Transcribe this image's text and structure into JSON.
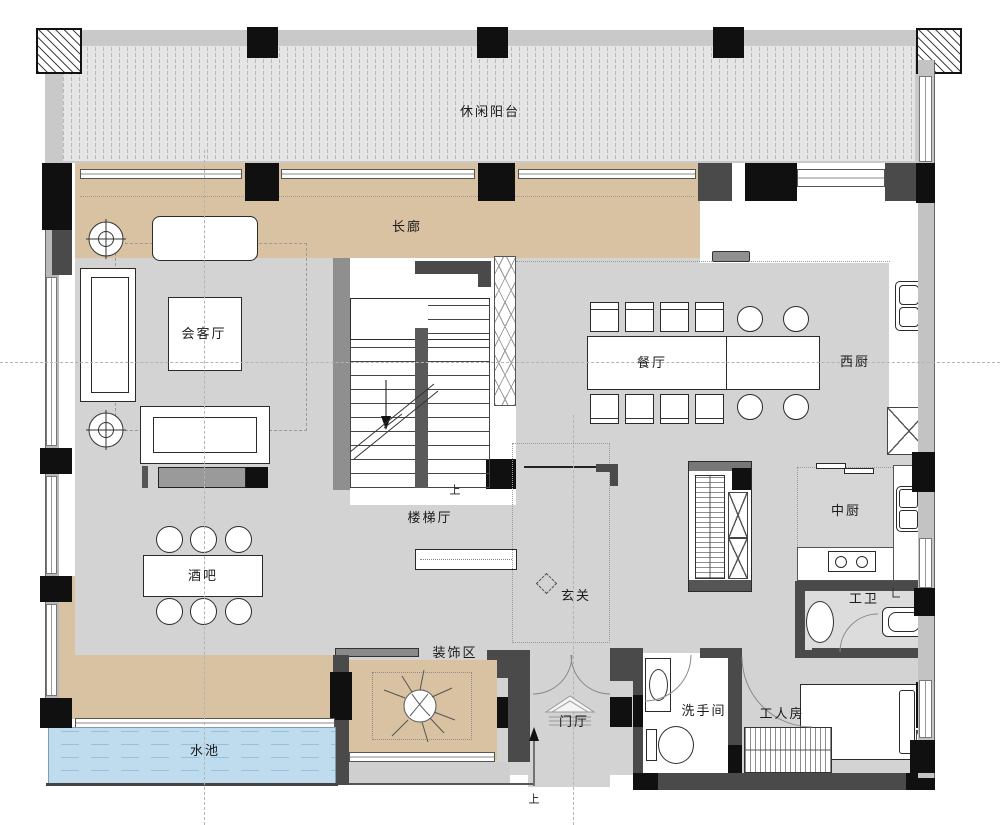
{
  "plan": {
    "labels": {
      "balcony": "休闲阳台",
      "corridor": "长廊",
      "reception": "会客厅",
      "dining": "餐厅",
      "west_kitchen": "西厨",
      "stair_hall": "楼梯厅",
      "up_stair": "上",
      "bar": "酒吧",
      "entry": "玄关",
      "chinese_kitchen": "中厨",
      "staff_bath": "工卫",
      "decoration": "装饰区",
      "powder_room": "洗手间",
      "staff_room": "工人房",
      "foyer": "门厅",
      "pool": "水池",
      "up_entrance": "上"
    },
    "colors": {
      "floor_grey": "#d3d3d3",
      "corridor_tan": "#d8c2a2",
      "pool_blue": "#bedced",
      "balcony_band": "#c9c9c9",
      "balcony_inner": "#e5e5e5",
      "wall_dark": "#4a4a4a",
      "wall_grey": "#8f8f8f",
      "column_black": "#101010"
    }
  }
}
